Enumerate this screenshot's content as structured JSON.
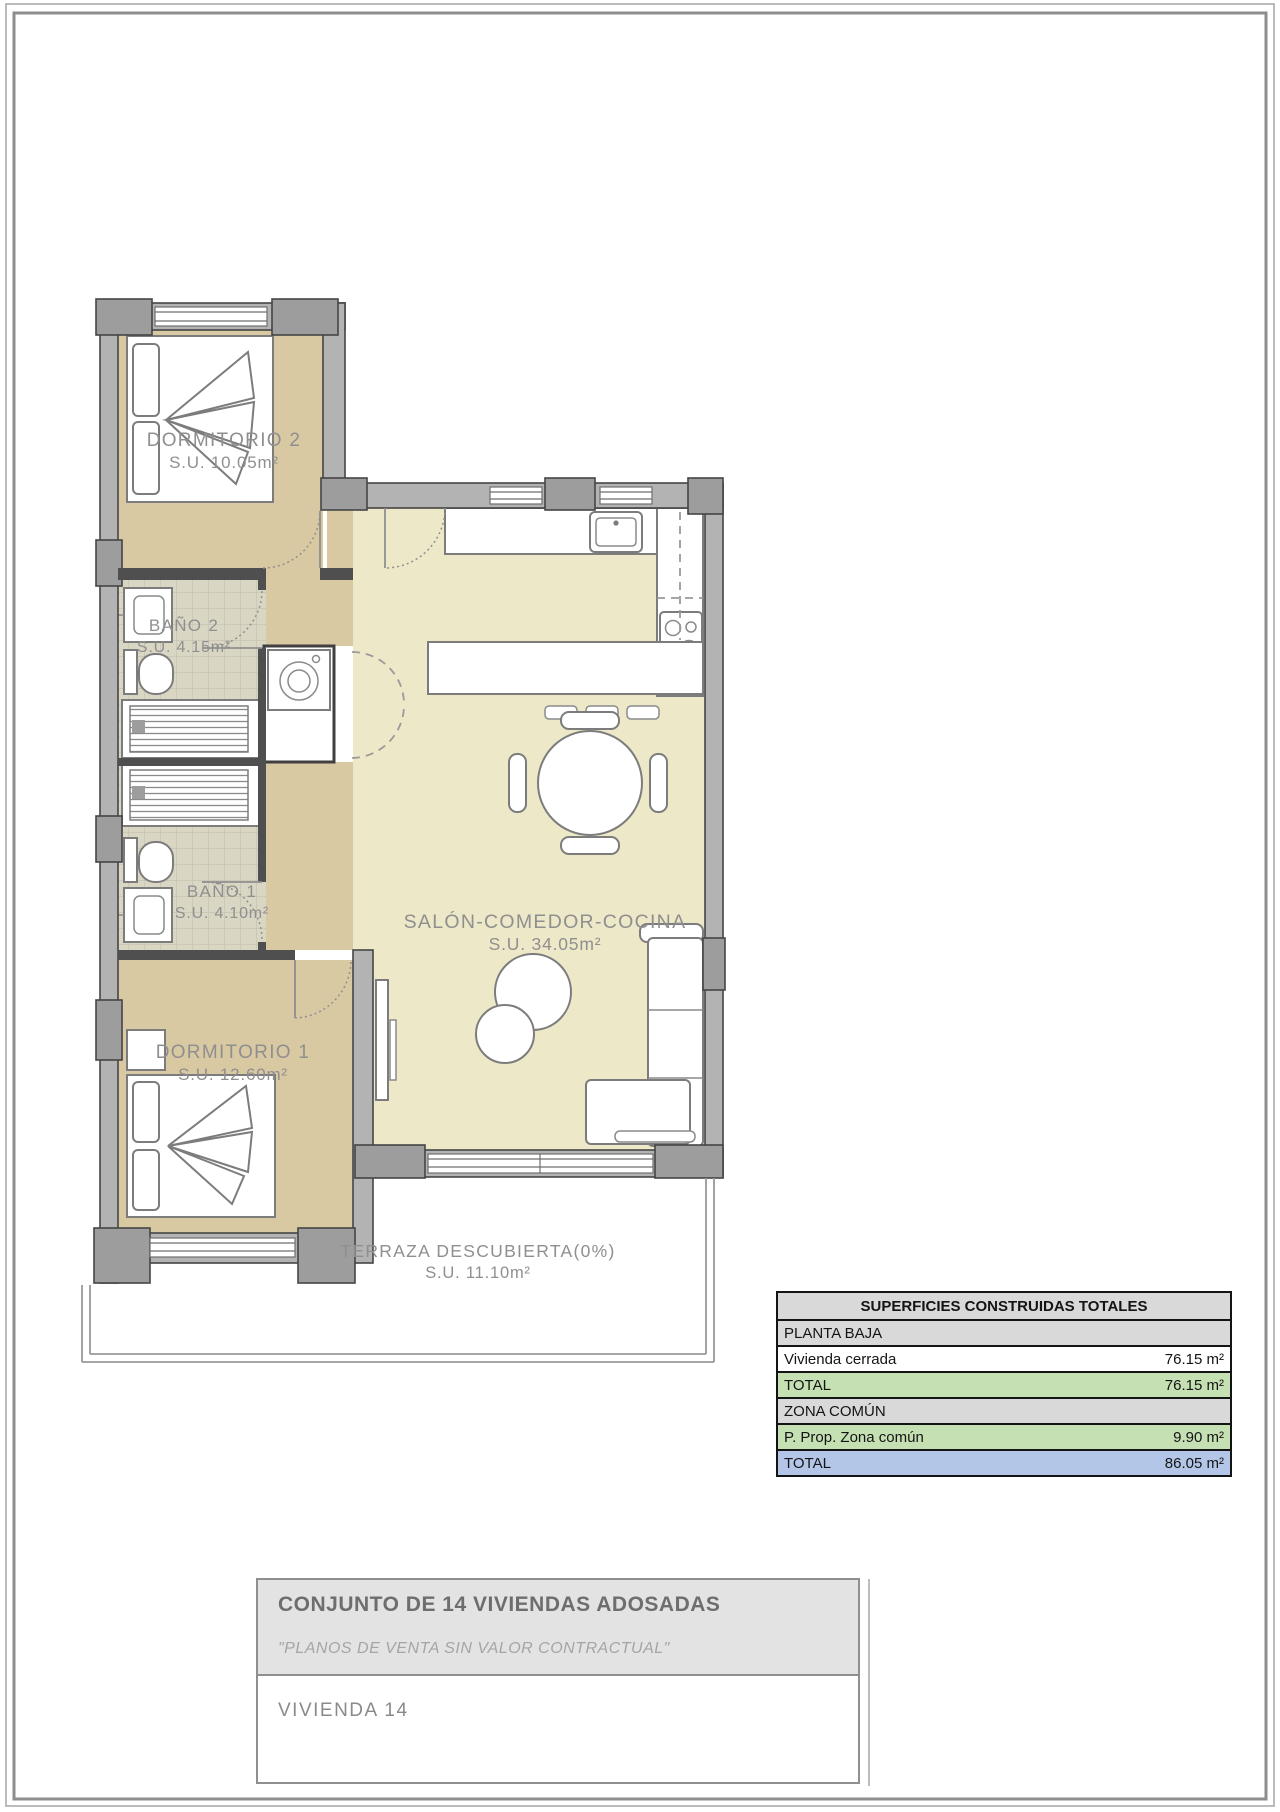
{
  "page": {
    "background": "#ffffff",
    "frame_color": "#8e8e8e"
  },
  "plan": {
    "rooms": [
      {
        "id": "dormitorio-2",
        "label": "DORMITORIO 2",
        "area": "S.U. 10.05m²"
      },
      {
        "id": "bano-2",
        "label": "BAÑO 2",
        "area": "S.U. 4.15m²"
      },
      {
        "id": "bano-1",
        "label": "BAÑO 1",
        "area": "S.U. 4.10m²"
      },
      {
        "id": "dormitorio-1",
        "label": "DORMITORIO 1",
        "area": "S.U. 12.60m²"
      },
      {
        "id": "salon",
        "label": "SALÓN-COMEDOR-COCINA",
        "area": "S.U. 34.05m²"
      },
      {
        "id": "terraza",
        "label": "TERRAZA DESCUBIERTA(0%)",
        "area": "S.U. 11.10m²"
      }
    ],
    "furniture": [
      "double-bed",
      "washbasin",
      "toilet",
      "bathtub",
      "washing-machine",
      "closet-doors",
      "kitchen-sink",
      "hob",
      "kitchen-counter",
      "bar-stool",
      "dining-table",
      "dining-chair",
      "coffee-table",
      "sofa",
      "tv-unit"
    ],
    "colors": {
      "bedroom_floor": "#d9c9a3",
      "salon_floor": "#ede8c8",
      "bath_floor": "#d9d6c4",
      "wall": "#b3b3b3",
      "column": "#9d9d9d",
      "wall_outline": "#454545",
      "furniture_outline": "#7c7c7c",
      "label_text": "#8f8f8f"
    }
  },
  "summary_table": {
    "title": "SUPERFICIES CONSTRUIDAS TOTALES",
    "rows": [
      {
        "label": "PLANTA BAJA",
        "value": ""
      },
      {
        "label": "Vivienda cerrada",
        "value": "76.15 m²"
      },
      {
        "label": "TOTAL",
        "value": "76.15 m²"
      },
      {
        "label": "ZONA COMÚN",
        "value": ""
      },
      {
        "label": "P. Prop. Zona común",
        "value": "9.90 m²"
      },
      {
        "label": "TOTAL",
        "value": "86.05 m²"
      }
    ],
    "row_colors": {
      "header": "#d9d9d9",
      "section": "#d9d9d9",
      "plain": "#ffffff",
      "green": "#c5e0b3",
      "blue": "#b4c6e7"
    }
  },
  "title_block": {
    "project_title": "CONJUNTO DE 14 VIVIENDAS ADOSADAS",
    "disclaimer": "\"PLANOS DE VENTA SIN VALOR CONTRACTUAL\"",
    "unit_name": "VIVIENDA 14"
  }
}
